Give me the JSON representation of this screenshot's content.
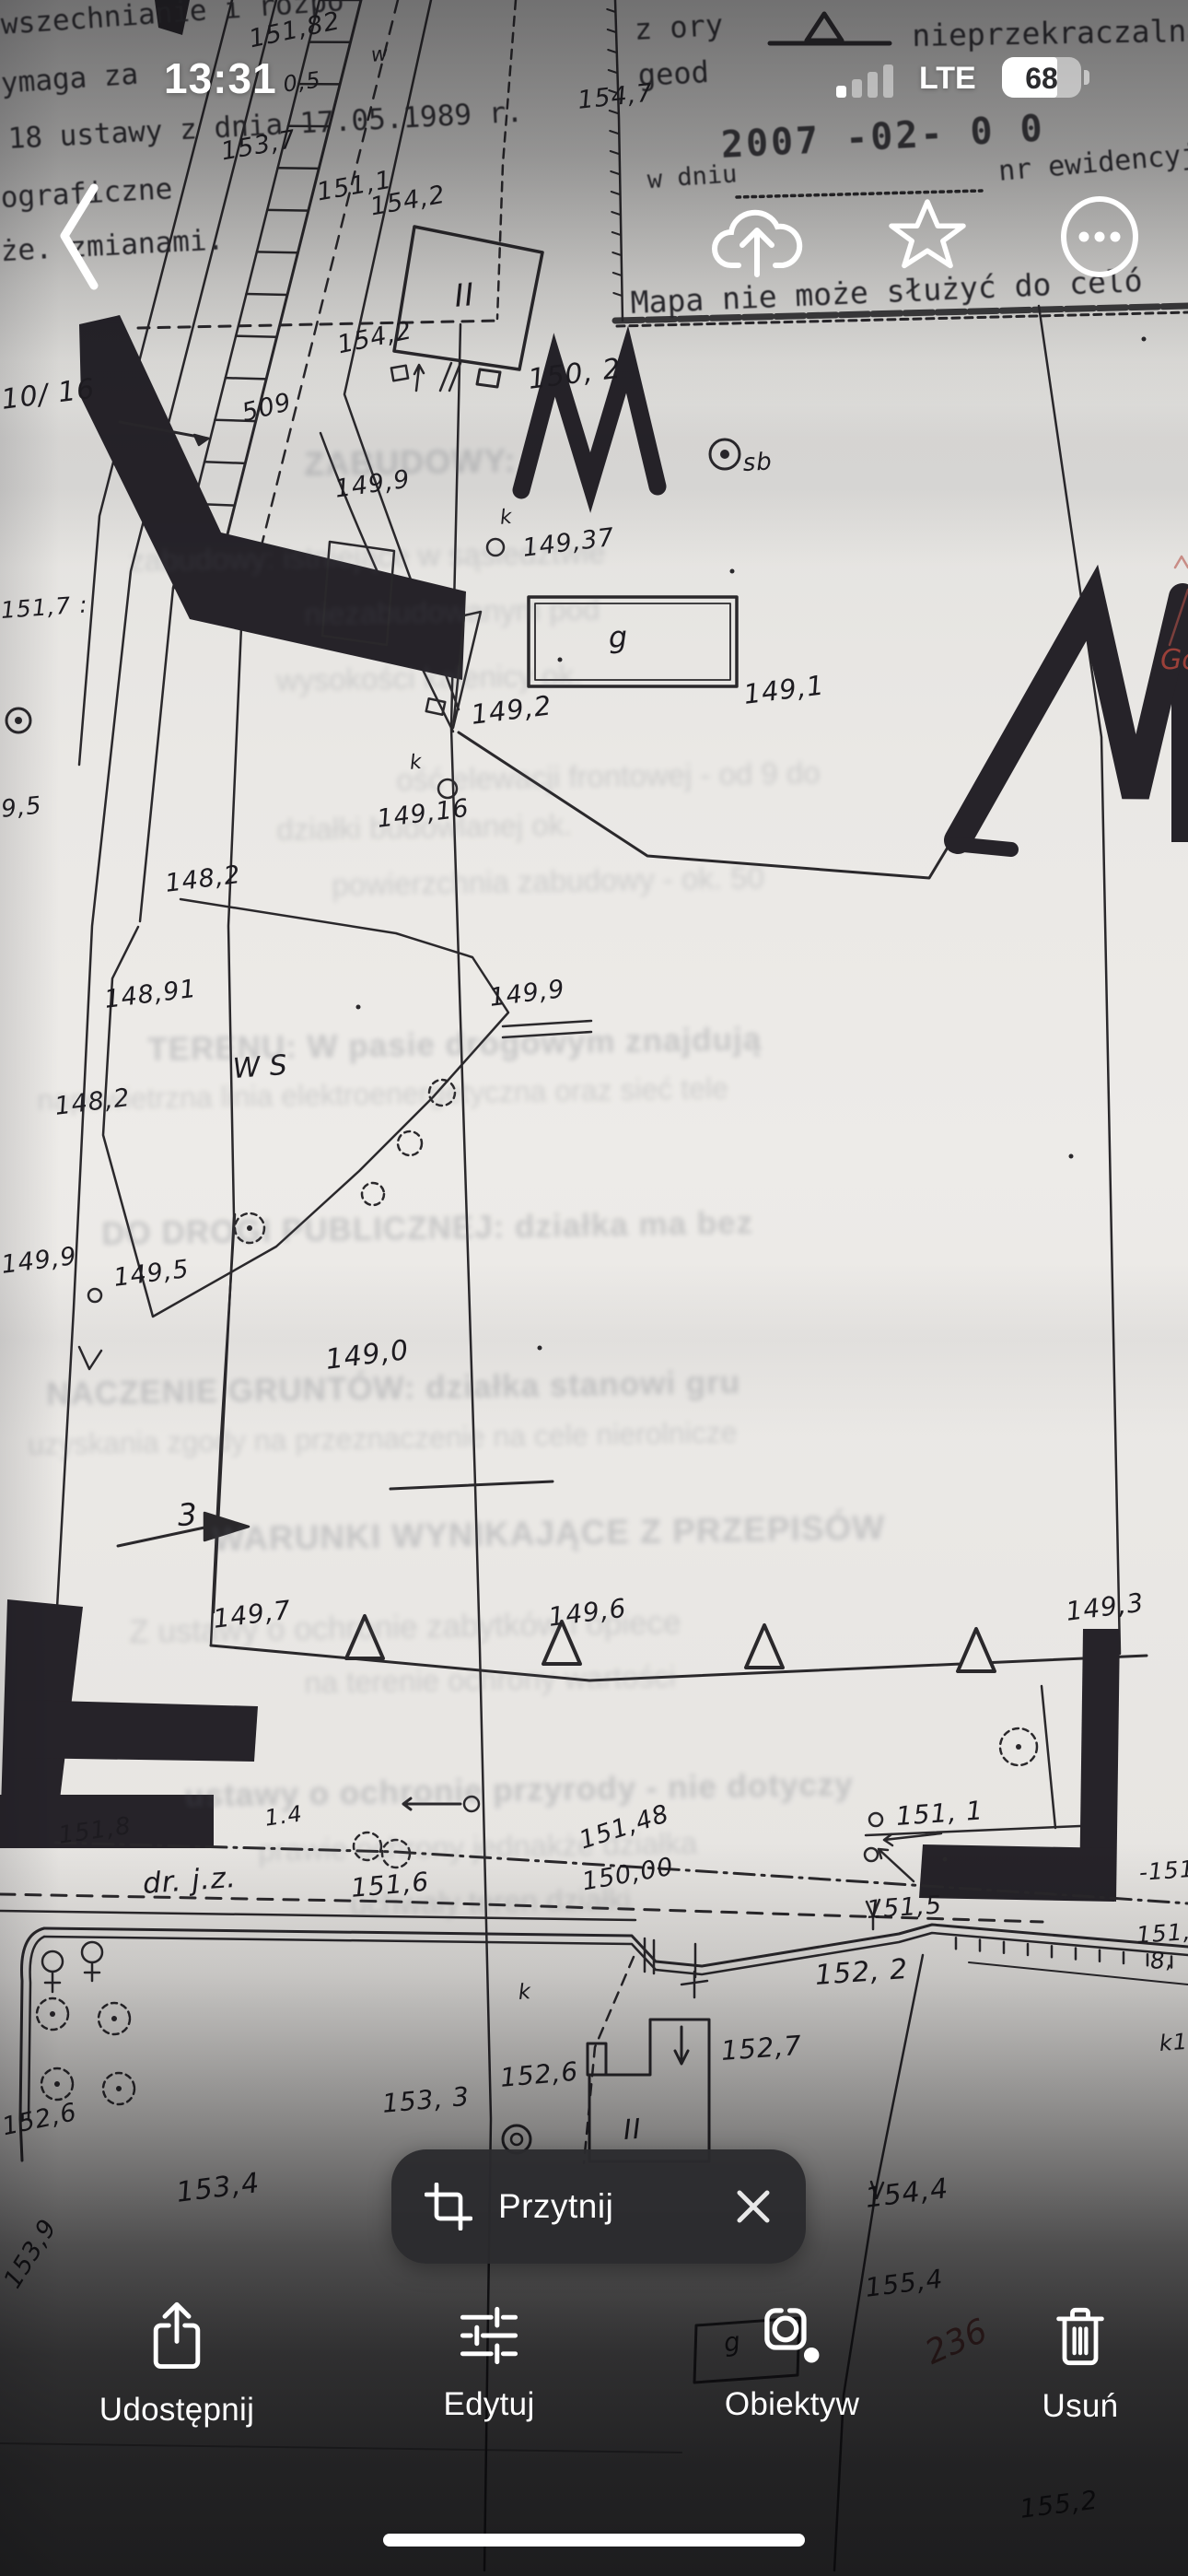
{
  "status_bar": {
    "time": "13:31",
    "network": "LTE",
    "battery_percent": "68"
  },
  "nav_icons": [
    "back-chevron",
    "cloud-upload",
    "star",
    "ellipsis-circle"
  ],
  "crop_chip": {
    "label": "Przytnij",
    "leading_icon": "crop-icon",
    "trailing_icon": "close-icon"
  },
  "toolbar": {
    "share_label": "Udostępnij",
    "edit_label": "Edytuj",
    "lens_label": "Obiektyw",
    "delete_label": "Usuń"
  },
  "map": {
    "colors": {
      "paper": "#eae8e5",
      "ink": "#1a181c",
      "red_note": "#b0463c"
    },
    "legend_symbol": "setback-triangle-on-line",
    "labels": [
      [
        "wszechnianie i rozpo",
        0,
        12,
        -4,
        31,
        "print"
      ],
      [
        "ymaga za",
        0,
        76,
        -4,
        31,
        "print"
      ],
      [
        "18 ustawy z dnia 17.05.1989 r.",
        8,
        136,
        -3,
        31,
        "print"
      ],
      [
        "ograficzne",
        0,
        200,
        -3,
        31,
        "print"
      ],
      [
        "że. zmianami.",
        0,
        258,
        -3,
        31,
        "print"
      ],
      [
        "z ory",
        688,
        16,
        -3,
        32,
        "print"
      ],
      [
        "geod",
        692,
        66,
        -3,
        32,
        "print"
      ],
      [
        "nieprzekraczalna",
        990,
        22,
        -1,
        33,
        "print"
      ],
      [
        "2007 -02- 0 0",
        782,
        138,
        -3,
        40,
        "stamp"
      ],
      [
        "w dniu",
        702,
        182,
        -4,
        27,
        "print"
      ],
      [
        "nr ewidencyjn",
        1083,
        172,
        -5,
        30,
        "print"
      ],
      [
        "Mapa nie może służyć do celó",
        684,
        312,
        -2.5,
        33,
        "print"
      ],
      [
        "151,82",
        268,
        30,
        -12,
        27,
        "hand"
      ],
      [
        "w",
        402,
        50,
        -5,
        22,
        "hand"
      ],
      [
        "0,5",
        306,
        80,
        -8,
        24,
        "hand"
      ],
      [
        "153,7",
        238,
        152,
        -10,
        27,
        "hand"
      ],
      [
        "151,1",
        342,
        196,
        -10,
        27,
        "hand"
      ],
      [
        "154,2",
        400,
        212,
        -10,
        27,
        "hand"
      ],
      [
        "154,7",
        626,
        96,
        -6,
        27,
        "hand"
      ],
      [
        "II",
        492,
        305,
        -5,
        34,
        "hand"
      ],
      [
        "154,2",
        364,
        362,
        -12,
        27,
        "hand"
      ],
      [
        "150, 2",
        572,
        398,
        -7,
        30,
        "hand"
      ],
      [
        "10/ 16",
        0,
        420,
        -7,
        30,
        "hand"
      ],
      [
        "509",
        260,
        436,
        -14,
        27,
        "hand"
      ],
      [
        "sb",
        806,
        490,
        -3,
        26,
        "hand"
      ],
      [
        "149,9",
        362,
        518,
        -8,
        27,
        "hand"
      ],
      [
        "k",
        542,
        552,
        -5,
        22,
        "hand"
      ],
      [
        "149,37",
        566,
        582,
        -7,
        27,
        "hand"
      ],
      [
        "151,7 :",
        0,
        650,
        -4,
        25,
        "hand"
      ],
      [
        "g",
        660,
        676,
        -3,
        32,
        "hand"
      ],
      [
        "149,2",
        510,
        762,
        -7,
        29,
        "hand"
      ],
      [
        "149,1",
        806,
        740,
        -7,
        29,
        "hand"
      ],
      [
        "9,5",
        0,
        866,
        -6,
        26,
        "hand"
      ],
      [
        "k",
        444,
        818,
        -5,
        22,
        "hand"
      ],
      [
        "149,16",
        408,
        876,
        -7,
        27,
        "hand"
      ],
      [
        "148,2",
        178,
        946,
        -7,
        27,
        "hand"
      ],
      [
        "148,91",
        112,
        1072,
        -7,
        27,
        "hand"
      ],
      [
        "149,9",
        530,
        1070,
        -7,
        27,
        "hand"
      ],
      [
        "WS",
        252,
        1146,
        -4,
        30,
        "hand ws"
      ],
      [
        "148,2",
        58,
        1188,
        -7,
        27,
        "hand"
      ],
      [
        "149,9",
        0,
        1360,
        -7,
        27,
        "hand"
      ],
      [
        "149,5",
        122,
        1374,
        -7,
        27,
        "hand"
      ],
      [
        "149,0",
        352,
        1462,
        -7,
        30,
        "hand"
      ],
      [
        "3",
        192,
        1628,
        -3,
        33,
        "hand"
      ],
      [
        "149,7",
        230,
        1744,
        -7,
        28,
        "hand"
      ],
      [
        "149,6",
        594,
        1742,
        -7,
        28,
        "hand"
      ],
      [
        "149,3",
        1156,
        1736,
        -7,
        28,
        "hand"
      ],
      [
        "151,8",
        62,
        1980,
        -8,
        26,
        "hand"
      ],
      [
        "1.4",
        286,
        1962,
        -8,
        24,
        "hand"
      ],
      [
        "dr. j.z.",
        154,
        2030,
        -4,
        31,
        "hand"
      ],
      [
        "151,6",
        380,
        2036,
        -5,
        28,
        "hand"
      ],
      [
        "151,48",
        626,
        1986,
        -18,
        27,
        "hand"
      ],
      [
        "150,00",
        630,
        2030,
        -10,
        27,
        "hand"
      ],
      [
        "151, 1",
        972,
        1958,
        -4,
        28,
        "hand"
      ],
      [
        "151,5",
        940,
        2060,
        -4,
        27,
        "hand"
      ],
      [
        "-151",
        1236,
        2020,
        -4,
        25,
        "hand"
      ],
      [
        "151,",
        1233,
        2088,
        -4,
        25,
        "hand"
      ],
      [
        "8,",
        1248,
        2116,
        -4,
        25,
        "hand"
      ],
      [
        "k1",
        1258,
        2206,
        -4,
        24,
        "hand"
      ],
      [
        "152, 2",
        884,
        2130,
        -4,
        30,
        "hand"
      ],
      [
        "k",
        562,
        2152,
        -4,
        23,
        "hand"
      ],
      [
        "152,7",
        782,
        2212,
        -4,
        29,
        "hand"
      ],
      [
        "152,6",
        542,
        2242,
        -5,
        28,
        "hand"
      ],
      [
        "153, 3",
        414,
        2270,
        -5,
        28,
        "hand"
      ],
      [
        "152,6",
        0,
        2296,
        -12,
        27,
        "hand"
      ],
      [
        "II",
        676,
        2298,
        -4,
        30,
        "hand"
      ],
      [
        "153,4",
        190,
        2366,
        -7,
        30,
        "hand"
      ],
      [
        "154,4",
        938,
        2372,
        -7,
        30,
        "hand"
      ],
      [
        "153,9",
        0,
        2474,
        -58,
        27,
        "hand"
      ],
      [
        "155,4",
        938,
        2470,
        -7,
        28,
        "hand"
      ],
      [
        "236",
        1000,
        2540,
        -24,
        36,
        "red2"
      ],
      [
        "g",
        784,
        2530,
        -8,
        28,
        "hand"
      ],
      [
        "155,2",
        1106,
        2710,
        -7,
        28,
        "hand"
      ],
      [
        "Gosp",
        1260,
        702,
        0,
        30,
        "red"
      ]
    ],
    "bleed_text": [
      [
        "ZABUDOWY:",
        330,
        486,
        36,
        1
      ],
      [
        "zabudowy: istniejące w sąsiedztwie",
        140,
        592,
        33,
        0
      ],
      [
        "niezabudowanym pod",
        330,
        650,
        33,
        0
      ],
      [
        "wysokości kalenicy ok.",
        300,
        722,
        33,
        0
      ],
      [
        "ość elewacji frontowej - od 9 do",
        430,
        830,
        33,
        0
      ],
      [
        "działki budowlanej ok.",
        300,
        884,
        33,
        0
      ],
      [
        "powierzchnia zabudowy - ok. 50",
        360,
        944,
        33,
        0
      ],
      [
        "TERENU: W pasie drogowym znajdują",
        160,
        1122,
        35,
        1
      ],
      [
        "napowietrzna linia elektroenergetyczna oraz sieć tele",
        40,
        1178,
        32,
        0
      ],
      [
        "DO DROGI PUBLICZNEJ: działka ma bez",
        110,
        1322,
        35,
        1
      ],
      [
        "NACZENIE GRUNTÓW: działka stanowi gru",
        50,
        1496,
        35,
        1
      ],
      [
        "uzyskania zgody na przeznaczenie na cele nierolnicze",
        30,
        1552,
        32,
        0
      ],
      [
        "WARUNKI WYNIKAJĄCE Z PRZEPISÓW",
        230,
        1652,
        37,
        1
      ],
      [
        "Z ustawy o ochronie zabytków i opiece",
        140,
        1754,
        35,
        0
      ],
      [
        "na terenie ochrony wartości",
        330,
        1810,
        33,
        0
      ],
      [
        "ustawy o ochronie przyrody - nie dotyczy",
        200,
        1932,
        35,
        1
      ],
      [
        "prawie ochrony jednakże działka",
        280,
        1992,
        33,
        0
      ],
      [
        "uchwały teren działki",
        380,
        2050,
        33,
        0
      ]
    ]
  }
}
